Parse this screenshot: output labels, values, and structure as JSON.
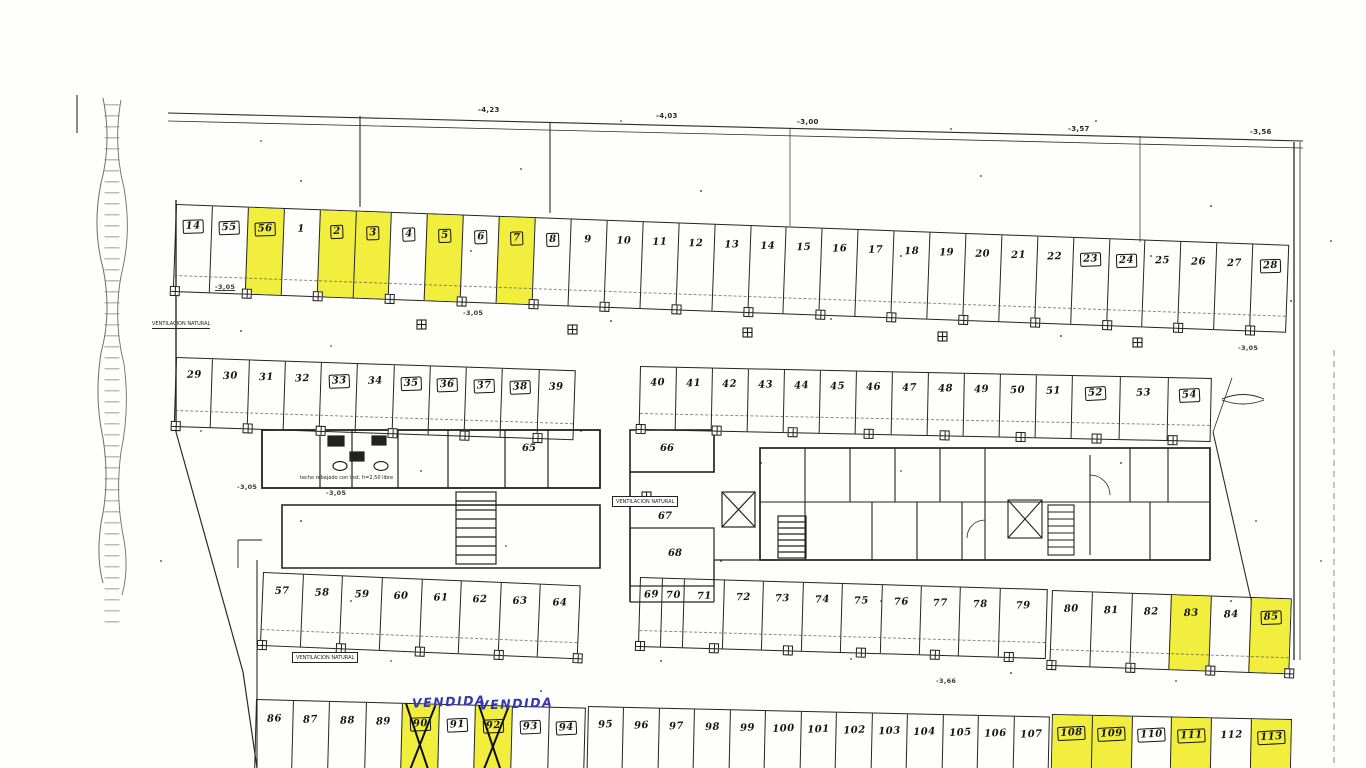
{
  "document": {
    "kind": "scanned parking / garage floor plan",
    "ink_color": "#1f1f1f",
    "highlight_color": "#f1ee3e",
    "handwriting_color": "#3437b2"
  },
  "top_levels": {
    "l1": "-4,23",
    "l2": "-4,03",
    "l3": "-3,00",
    "l4": "-3,57",
    "l5": "-3,56"
  },
  "annotations": {
    "vendida": "VENDIDA",
    "ventilacion": "VENTILACION NATURAL",
    "techo": "techo rebajado con inst. h=2,50 libre",
    "level_a": "-3,05",
    "level_b": "-3,66"
  },
  "rooms": {
    "r65": "65",
    "r66": "66",
    "r67": "67",
    "r68": "68"
  },
  "rows": {
    "top": {
      "cells": [
        {
          "t": "14",
          "b": 1
        },
        {
          "t": "55",
          "b": 1
        },
        {
          "t": "56",
          "b": 1,
          "y": 1
        },
        {
          "t": "1"
        },
        {
          "t": "2",
          "b": 1,
          "y": 1
        },
        {
          "t": "3",
          "b": 1,
          "y": 1
        },
        {
          "t": "4",
          "b": 1
        },
        {
          "t": "5",
          "b": 1,
          "y": 1
        },
        {
          "t": "6",
          "b": 1
        },
        {
          "t": "7",
          "b": 1,
          "y": 1
        },
        {
          "t": "8",
          "b": 1
        },
        {
          "t": "9"
        },
        {
          "t": "10"
        },
        {
          "t": "11"
        },
        {
          "t": "12"
        },
        {
          "t": "13"
        },
        {
          "t": "14"
        },
        {
          "t": "15"
        },
        {
          "t": "16"
        },
        {
          "t": "17"
        },
        {
          "t": "18"
        },
        {
          "t": "19"
        },
        {
          "t": "20"
        },
        {
          "t": "21"
        },
        {
          "t": "22"
        },
        {
          "t": "23",
          "b": 1
        },
        {
          "t": "24",
          "b": 1
        },
        {
          "t": "25"
        },
        {
          "t": "26"
        },
        {
          "t": "27"
        },
        {
          "t": "28",
          "b": 1
        }
      ]
    },
    "row2_left": {
      "cells": [
        {
          "t": "29"
        },
        {
          "t": "30"
        },
        {
          "t": "31"
        },
        {
          "t": "32"
        },
        {
          "t": "33",
          "b": 1
        },
        {
          "t": "34"
        },
        {
          "t": "35",
          "b": 1
        },
        {
          "t": "36",
          "b": 1
        },
        {
          "t": "37",
          "b": 1
        },
        {
          "t": "38",
          "b": 1
        },
        {
          "t": "39"
        }
      ]
    },
    "row2_right": {
      "cells": [
        {
          "t": "40"
        },
        {
          "t": "41"
        },
        {
          "t": "42"
        },
        {
          "t": "43"
        },
        {
          "t": "44"
        },
        {
          "t": "45"
        },
        {
          "t": "46"
        },
        {
          "t": "47"
        },
        {
          "t": "48"
        },
        {
          "t": "49"
        },
        {
          "t": "50"
        },
        {
          "t": "51"
        },
        {
          "t": "52",
          "b": 1,
          "f": "1.35"
        },
        {
          "t": "53",
          "f": "1.35"
        },
        {
          "t": "54",
          "b": 1,
          "f": "1.2"
        }
      ]
    },
    "row3_left": {
      "cells": [
        {
          "t": "57"
        },
        {
          "t": "58"
        },
        {
          "t": "59"
        },
        {
          "t": "60"
        },
        {
          "t": "61"
        },
        {
          "t": "62"
        },
        {
          "t": "63"
        },
        {
          "t": "64"
        }
      ]
    },
    "row3_mid": {
      "cells": [
        {
          "t": "69",
          "f": "0.55"
        },
        {
          "t": "70",
          "f": "0.55"
        },
        {
          "t": "71"
        },
        {
          "t": "72"
        },
        {
          "t": "73"
        },
        {
          "t": "74"
        },
        {
          "t": "75"
        },
        {
          "t": "76"
        },
        {
          "t": "77"
        },
        {
          "t": "78"
        },
        {
          "t": "79",
          "f": "1.2"
        }
      ]
    },
    "row3_right": {
      "cells": [
        {
          "t": "80"
        },
        {
          "t": "81"
        },
        {
          "t": "82"
        },
        {
          "t": "83",
          "y": 1
        },
        {
          "t": "84"
        },
        {
          "t": "85",
          "b": 1,
          "y": 1
        }
      ]
    },
    "bottom_left": {
      "cells": [
        {
          "t": "86"
        },
        {
          "t": "87"
        },
        {
          "t": "88"
        },
        {
          "t": "89"
        },
        {
          "t": "90",
          "b": 1,
          "y": 1,
          "x": 1
        },
        {
          "t": "91",
          "b": 1
        },
        {
          "t": "92",
          "b": 1,
          "y": 1,
          "x": 1
        },
        {
          "t": "93",
          "b": 1
        },
        {
          "t": "94",
          "b": 1
        }
      ]
    },
    "bottom_mid": {
      "cells": [
        {
          "t": "95"
        },
        {
          "t": "96"
        },
        {
          "t": "97"
        },
        {
          "t": "98"
        },
        {
          "t": "99"
        },
        {
          "t": "100"
        },
        {
          "t": "101"
        },
        {
          "t": "102"
        },
        {
          "t": "103"
        },
        {
          "t": "104"
        },
        {
          "t": "105"
        },
        {
          "t": "106"
        },
        {
          "t": "107"
        }
      ]
    },
    "bottom_right": {
      "cells": [
        {
          "t": "108",
          "b": 1,
          "y": 1
        },
        {
          "t": "109",
          "b": 1,
          "y": 1
        },
        {
          "t": "110",
          "b": 1
        },
        {
          "t": "111",
          "b": 1,
          "y": 1
        },
        {
          "t": "112"
        },
        {
          "t": "113",
          "b": 1,
          "y": 1
        }
      ]
    }
  }
}
